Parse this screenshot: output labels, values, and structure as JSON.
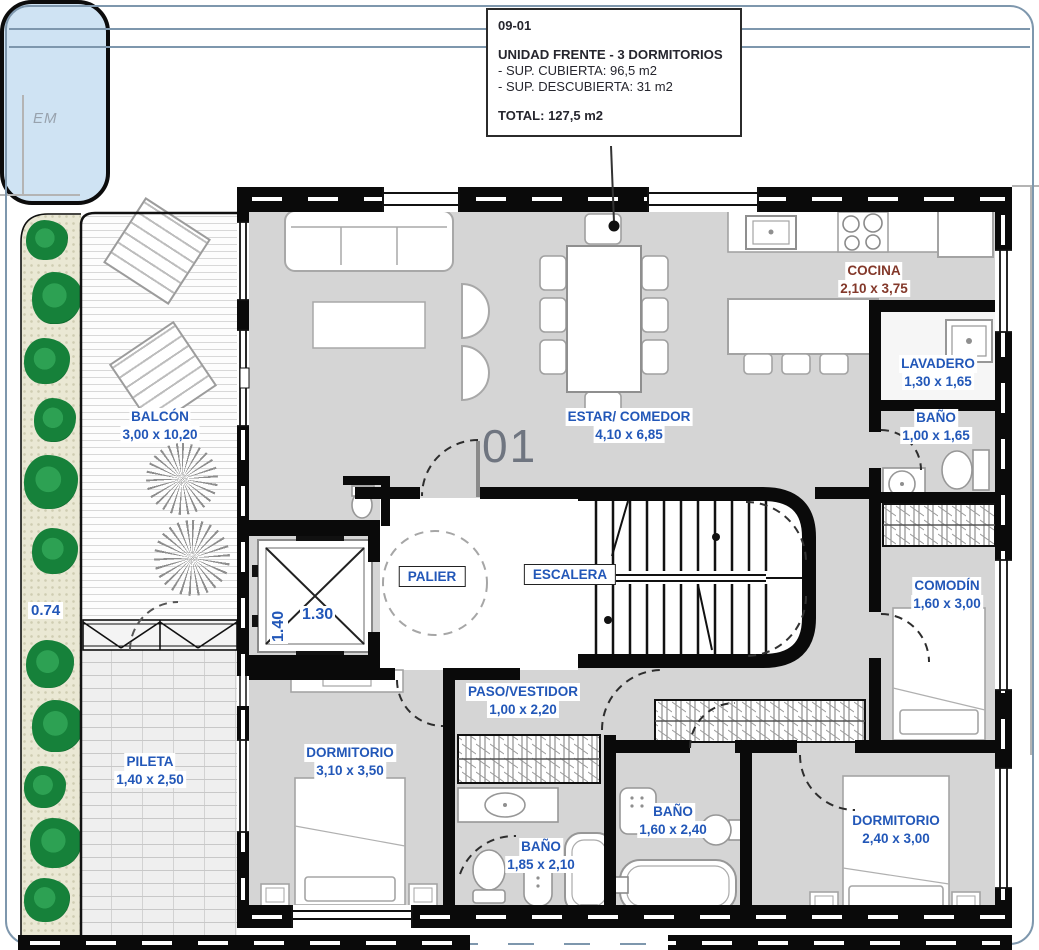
{
  "info_box": {
    "code": "09-01",
    "title": "UNIDAD FRENTE - 3 DORMITORIOS",
    "lines": [
      "- SUP. CUBIERTA: 96,5 m2",
      "- SUP. DESCUBIERTA: 31 m2"
    ],
    "total": "TOTAL: 127,5 m2"
  },
  "annotations": {
    "em": "EM",
    "unit_number": "01",
    "planter_width": "0.74",
    "elevator_width": "1.40",
    "elevator_depth": "1.30"
  },
  "rooms": [
    {
      "name": "BALCÓN",
      "dims": "3,00 x 10,20"
    },
    {
      "name": "COCINA",
      "dims": "2,10 x 3,75"
    },
    {
      "name": "LAVADERO",
      "dims": "1,30 x 1,65"
    },
    {
      "name": "BAÑO",
      "dims": "1,00 x 1,65"
    },
    {
      "name": "ESTAR/ COMEDOR",
      "dims": "4,10 x 6,85"
    },
    {
      "name": "PALIER",
      "dims": ""
    },
    {
      "name": "ESCALERA",
      "dims": ""
    },
    {
      "name": "COMODÍN",
      "dims": "1,60 x 3,00"
    },
    {
      "name": "PASO/VESTIDOR",
      "dims": "1,00 x 2,20"
    },
    {
      "name": "DORMITORIO",
      "dims": "3,10 x 3,50"
    },
    {
      "name": "BAÑO",
      "dims": "1,85 x 2,10"
    },
    {
      "name": "BAÑO",
      "dims": "1,60 x 2,40"
    },
    {
      "name": "DORMITORIO",
      "dims": "2,40 x 3,00"
    },
    {
      "name": "PILETA",
      "dims": "1,40 x 2,50"
    }
  ],
  "colors": {
    "room_label_blue": "#2257b8",
    "cocina_label_red": "#83382a",
    "wall_black": "#0a0a0a",
    "floor_gray": "#d5d5d5",
    "pool_blue": "#cfe3f3",
    "plant_green": "#16813a",
    "unit_number_gray": "#6f7580",
    "info_text": "#26262e"
  }
}
